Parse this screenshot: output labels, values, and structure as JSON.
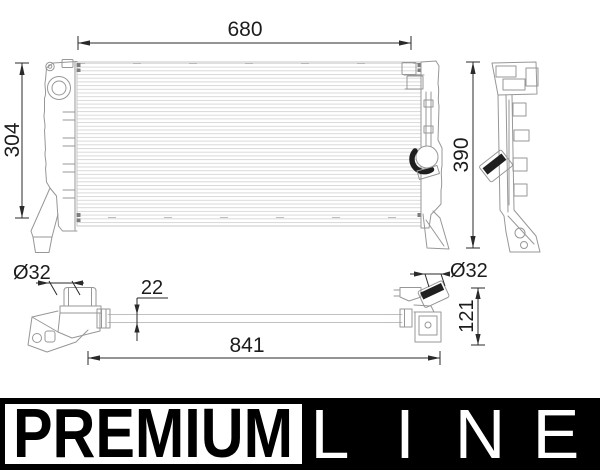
{
  "dimensions": {
    "top_width": "680",
    "left_height": "304",
    "right_height": "390",
    "left_port_diameter": "Ø32",
    "pipe_thickness": "22",
    "overall_width": "841",
    "right_port_diameter": "Ø32",
    "bottom_view_height": "121"
  },
  "banner": {
    "premium": "PREMIUM",
    "line_letters": [
      "L",
      "I",
      "N",
      "E"
    ]
  },
  "colors": {
    "dimension_ink": "#1c1c1c",
    "outline_gray": "#979797",
    "fin_gray": "#d9d9d9",
    "cap_black": "#1f1f1f",
    "banner_black": "#000000",
    "banner_white": "#ffffff"
  }
}
